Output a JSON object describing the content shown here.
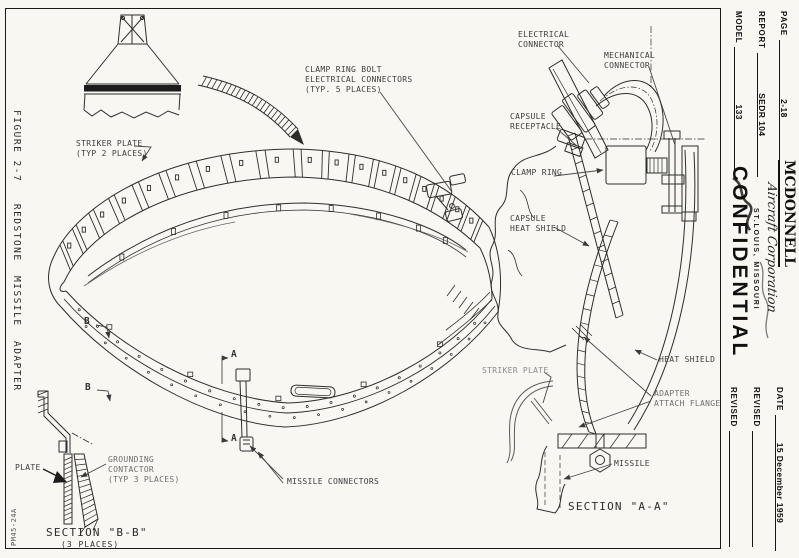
{
  "page": {
    "figure_caption": "FIGURE 2-7   REDSTONE  MISSILE  ADAPTER",
    "drawing_number": "PM45-24A"
  },
  "title_block": {
    "page": {
      "label": "PAGE",
      "value": "2-18"
    },
    "report": {
      "label": "REPORT",
      "value": "SEDR 104"
    },
    "model": {
      "label": "MODEL",
      "value": "133"
    },
    "company": {
      "name": "MCDONNELL",
      "script": "Aircraft Corporation",
      "location": "ST.LOUIS, MISSOURI"
    },
    "classification": "CONFIDENTIAL",
    "date": {
      "label": "DATE",
      "value": "15 December 1959"
    },
    "revised1": {
      "label": "REVISED",
      "value": ""
    },
    "revised2": {
      "label": "REVISED",
      "value": ""
    }
  },
  "callouts": {
    "striker_plate_typ": "STRIKER PLATE\n(TYP 2 PLACES)",
    "clamp_ring_bolt": "CLAMP RING BOLT\nELECTRICAL CONNECTORS\n(TYP. 5 PLACES)",
    "missile_connectors": "MISSILE CONNECTORS",
    "electrical_connector": "ELECTRICAL\nCONNECTOR",
    "mechanical_connector": "MECHANICAL\nCONNECTOR",
    "capsule_receptacle": "CAPSULE\nRECEPTACLE",
    "clamp_ring": "CLAMP RING",
    "capsule_heat_shield": "CAPSULE\nHEAT SHIELD",
    "heat_shield": "HEAT SHIELD",
    "striker_plate": "STRIKER PLATE",
    "adapter_attach_flange": "ADAPTER\nATTACH FLANGE",
    "missile": "MISSILE",
    "plate": "PLATE",
    "grounding_contactor": "GROUNDING\nCONTACTOR\n(TYP 3 PLACES)"
  },
  "sections": {
    "a": "SECTION \"A-A\"",
    "b": "SECTION \"B-B\"",
    "b_note": "(3 PLACES)"
  },
  "markers": {
    "a": "A",
    "b": "B"
  }
}
